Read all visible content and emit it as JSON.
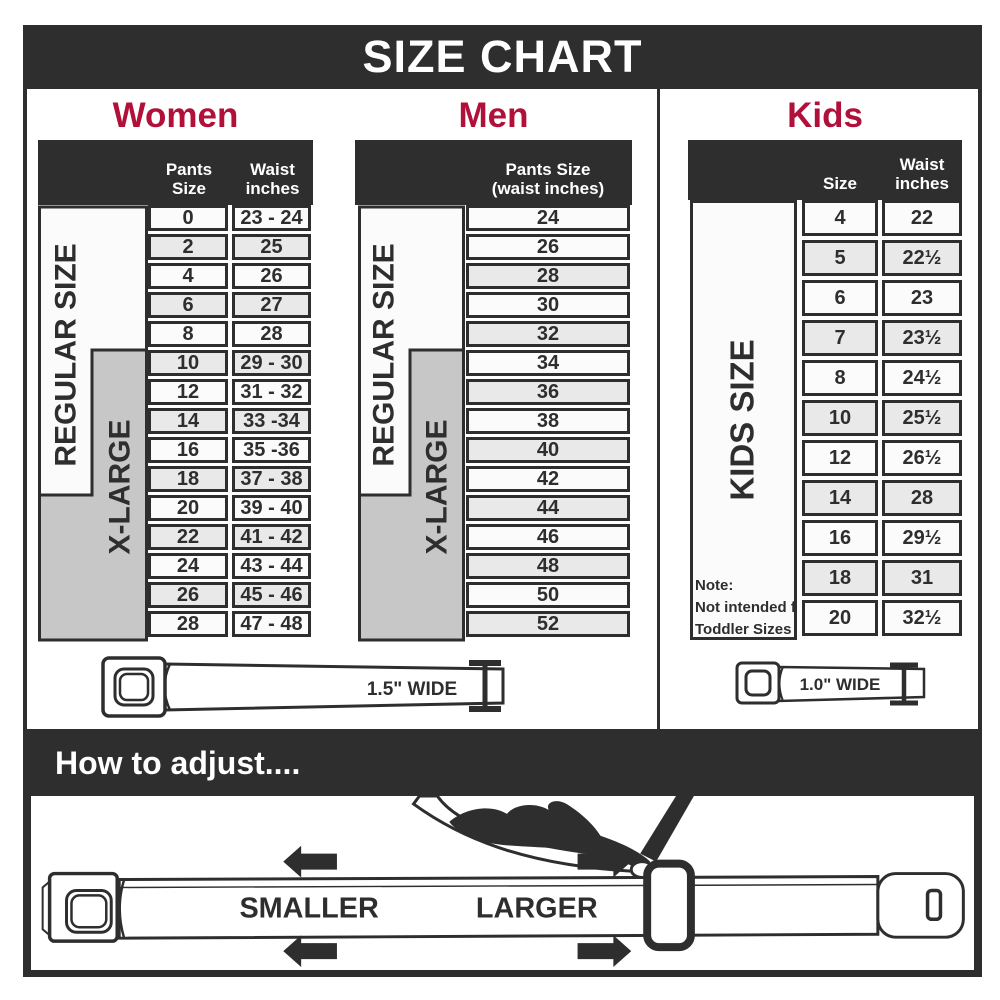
{
  "title": "SIZE CHART",
  "colors": {
    "dark": "#2e2e2e",
    "accent": "#b01039",
    "gray_box": "#c7c7c7",
    "row_shaded": "#e9e9e9",
    "row_plain": "#fbfbfb"
  },
  "women": {
    "heading": "Women",
    "pants_header": "Pants Size",
    "waist_header_line1": "Waist",
    "waist_header_line2": "inches",
    "regular_label": "REGULAR SIZE",
    "xlarge_label": "X-LARGE",
    "rows": [
      {
        "size": "0",
        "waist": "23 - 24"
      },
      {
        "size": "2",
        "waist": "25"
      },
      {
        "size": "4",
        "waist": "26"
      },
      {
        "size": "6",
        "waist": "27"
      },
      {
        "size": "8",
        "waist": "28"
      },
      {
        "size": "10",
        "waist": "29 - 30"
      },
      {
        "size": "12",
        "waist": "31 - 32"
      },
      {
        "size": "14",
        "waist": "33 -34"
      },
      {
        "size": "16",
        "waist": "35 -36"
      },
      {
        "size": "18",
        "waist": "37 - 38"
      },
      {
        "size": "20",
        "waist": "39 - 40"
      },
      {
        "size": "22",
        "waist": "41 - 42"
      },
      {
        "size": "24",
        "waist": "43 - 44"
      },
      {
        "size": "26",
        "waist": "45 - 46"
      },
      {
        "size": "28",
        "waist": "47 - 48"
      }
    ]
  },
  "men": {
    "heading": "Men",
    "col_header_line1": "Pants Size",
    "col_header_line2": "(waist inches)",
    "regular_label": "REGULAR SIZE",
    "xlarge_label": "X-LARGE",
    "rows": [
      "24",
      "26",
      "28",
      "30",
      "32",
      "34",
      "36",
      "38",
      "40",
      "42",
      "44",
      "46",
      "48",
      "50",
      "52"
    ]
  },
  "kids": {
    "heading": "Kids",
    "size_header": "Size",
    "waist_header_line1": "Waist",
    "waist_header_line2": "inches",
    "side_label": "KIDS SIZE",
    "note_line1": "Note:",
    "note_line2": "Not intended for",
    "note_line3": "Toddler Sizes (T)",
    "rows": [
      {
        "size": "4",
        "waist": "22"
      },
      {
        "size": "5",
        "waist": "22½"
      },
      {
        "size": "6",
        "waist": "23"
      },
      {
        "size": "7",
        "waist": "23½"
      },
      {
        "size": "8",
        "waist": "24½"
      },
      {
        "size": "10",
        "waist": "25½"
      },
      {
        "size": "12",
        "waist": "26½"
      },
      {
        "size": "14",
        "waist": "28"
      },
      {
        "size": "16",
        "waist": "29½"
      },
      {
        "size": "18",
        "waist": "31"
      },
      {
        "size": "20",
        "waist": "32½"
      }
    ]
  },
  "belts": {
    "adult_width": "1.5\" WIDE",
    "kids_width": "1.0\" WIDE"
  },
  "adjust": {
    "heading": "How to adjust....",
    "smaller": "SMALLER",
    "larger": "LARGER"
  }
}
